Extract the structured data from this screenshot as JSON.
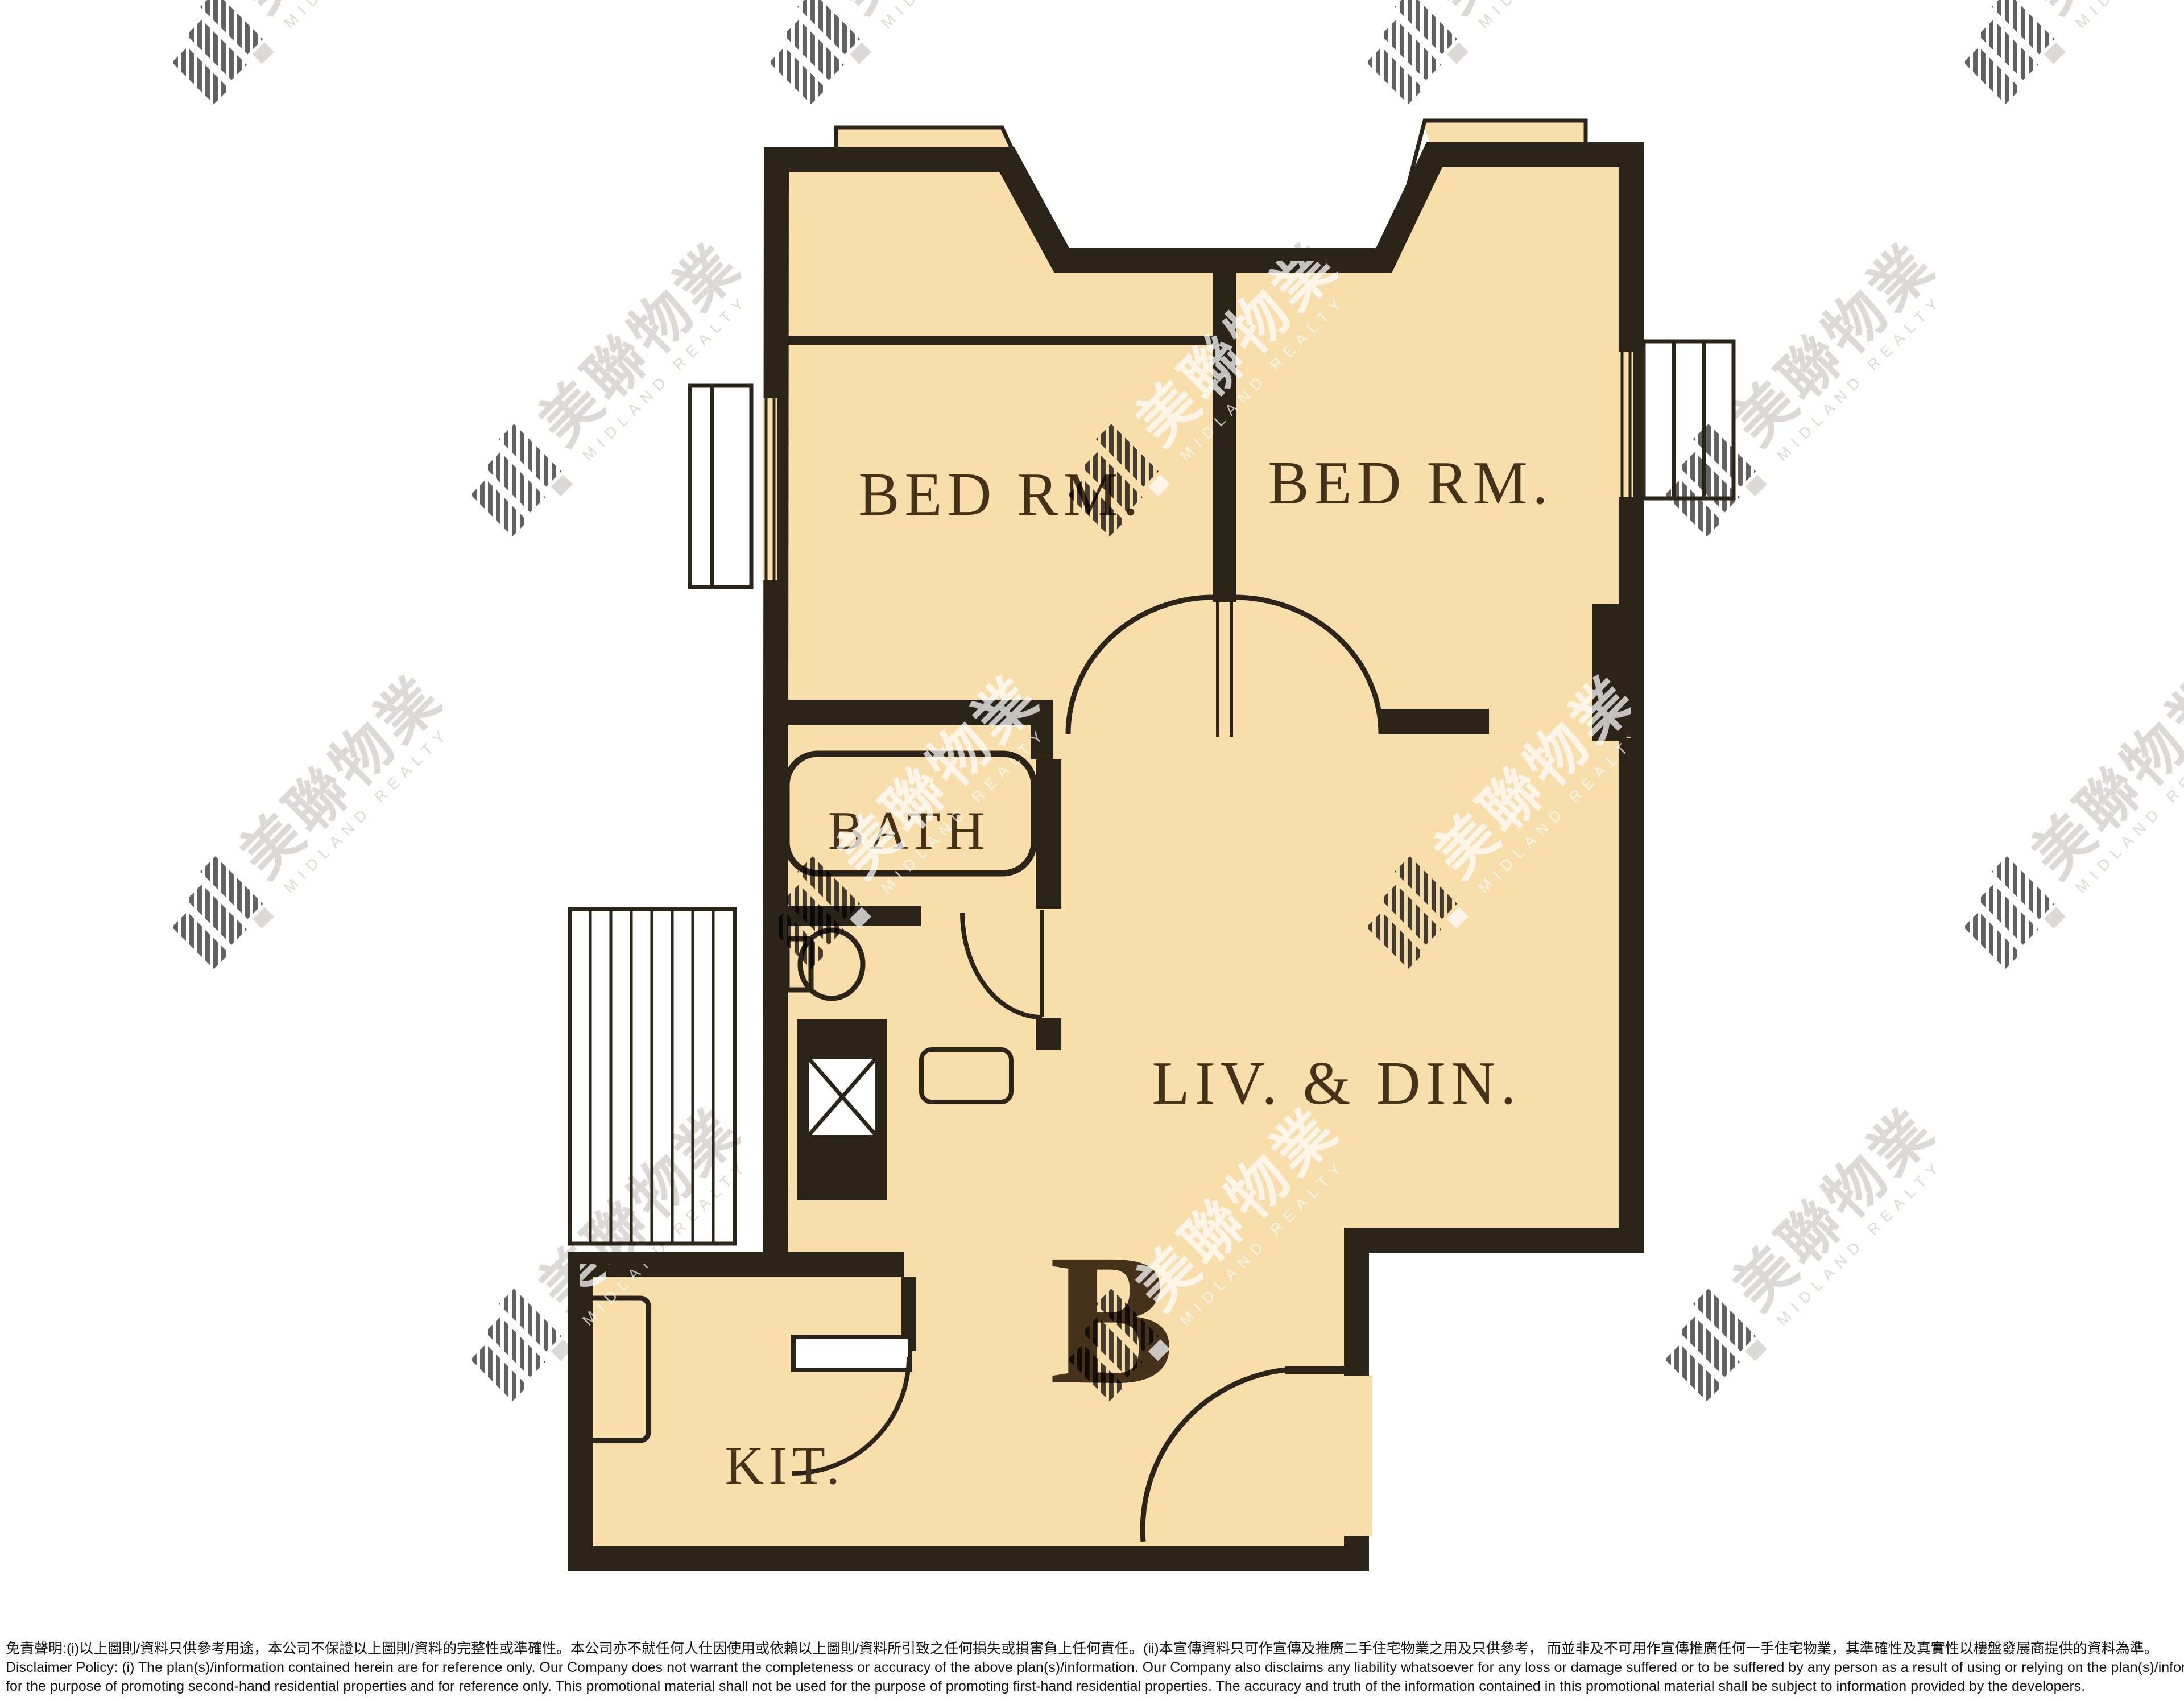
{
  "page": {
    "background": "#ffffff"
  },
  "watermark": {
    "logo": "midland-logo",
    "text_cn": "美聯物業",
    "text_en": "MIDLAND REALTY"
  },
  "floor_plan": {
    "unit_label": "B",
    "labels": {
      "bedroom_left": "BED RM.",
      "bedroom_right": "BED RM.",
      "living_dining": "LIV. & DIN.",
      "bathroom": "BATH",
      "kitchen": "KIT."
    },
    "colors": {
      "floor": "#f8deab",
      "wall": "#2b2418",
      "label_text": "#46321a",
      "watermark_gray": "#c6c3bf"
    }
  },
  "disclaimer": {
    "zh": "免責聲明:(i)以上圖則/資料只供參考用途，本公司不保證以上圖則/資料的完整性或準確性。本公司亦不就任何人仕因使用或依賴以上圖則/資料所引致之任何損失或損害負上任何責任。(ii)本宣傳資料只可作宣傳及推廣二手住宅物業之用及只供參考， 而並非及不可用作宣傳推廣任何一手住宅物業，其準確性及真實性以樓盤發展商提供的資料為準。",
    "en_line1": "Disclaimer Policy: (i) The plan(s)/information contained herein are for reference only. Our Company does not warrant the completeness or accuracy of the above plan(s)/information. Our Company also disclaims any liability whatsoever for any loss or damage suffered or to be suffered by any person as a result of using or relying on the plan(s)/information. (ii) This promotional material is",
    "en_line2": "for the purpose of promoting second-hand residential properties and for reference only. This promotional material shall not be used for the purpose of promoting first-hand residential properties. The accuracy and truth of the information contained in this promotional material shall be subject to information provided by the developers."
  }
}
